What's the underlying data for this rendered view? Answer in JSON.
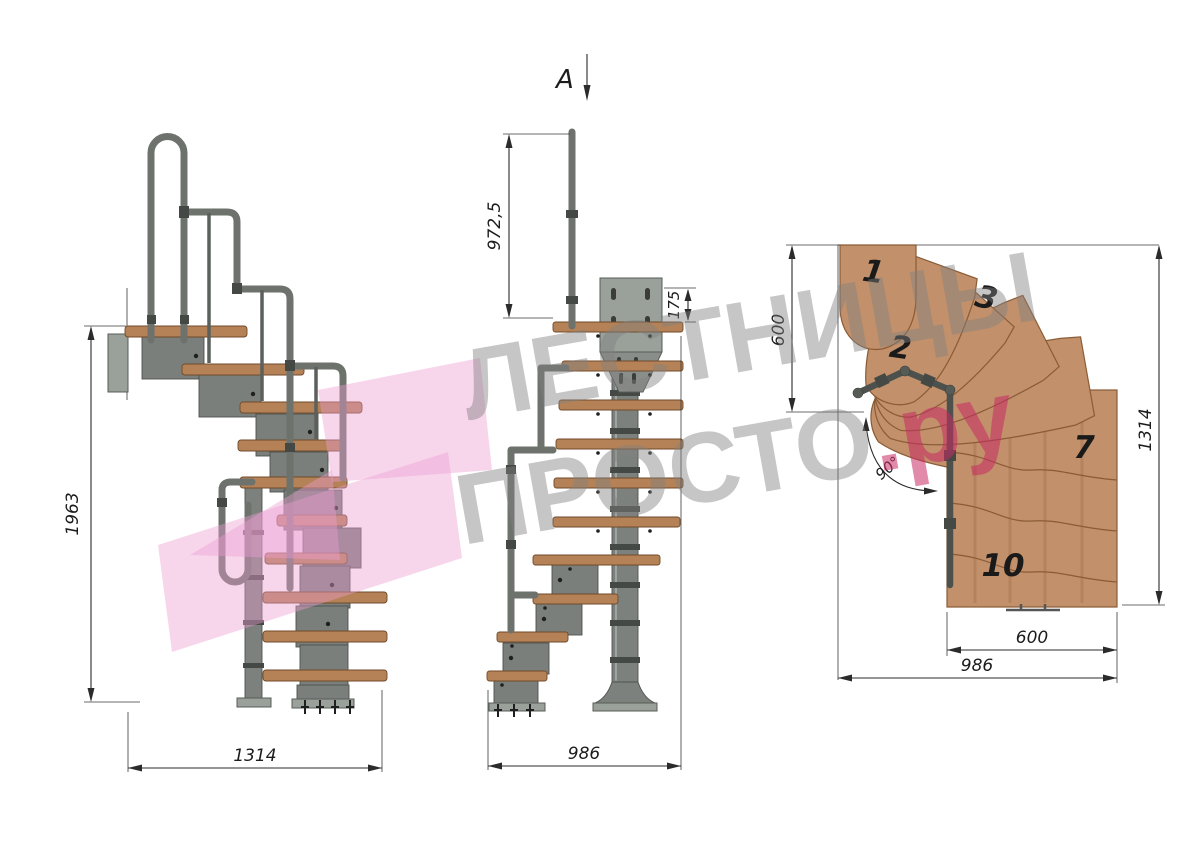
{
  "colors": {
    "background": "#ffffff",
    "wood_plan": "#c2906a",
    "wood_edge": "#8a5c36",
    "wood_side": "#b58257",
    "metal": "#7d817d",
    "metal_dark": "#4e524e",
    "tube": "#6d726d",
    "dimension": "#2b2b2b",
    "watermark_gray": "#8c8c8c",
    "watermark_pink": "#ec9ed2",
    "watermark_accent": "#c92a63"
  },
  "side_view": {
    "dim_height": "1963",
    "dim_run": "1314"
  },
  "front_view": {
    "view_label": "A",
    "dim_post_height": "972,5",
    "dim_bracket_height": "175",
    "dim_run": "986"
  },
  "plan_view": {
    "dim_upper_run": "600",
    "dim_total_length": "1314",
    "dim_turn_angle": "90°",
    "dim_flight_width": "600",
    "dim_total_width": "986",
    "steps": [
      {
        "label": "1"
      },
      {
        "label": "2"
      },
      {
        "label": "3"
      },
      {
        "label": "7"
      },
      {
        "label": "10"
      }
    ]
  },
  "watermark": {
    "line1": "ЛЕСТНИЦЫ",
    "line2": "ПРОСТО",
    "accent": ".ру"
  }
}
